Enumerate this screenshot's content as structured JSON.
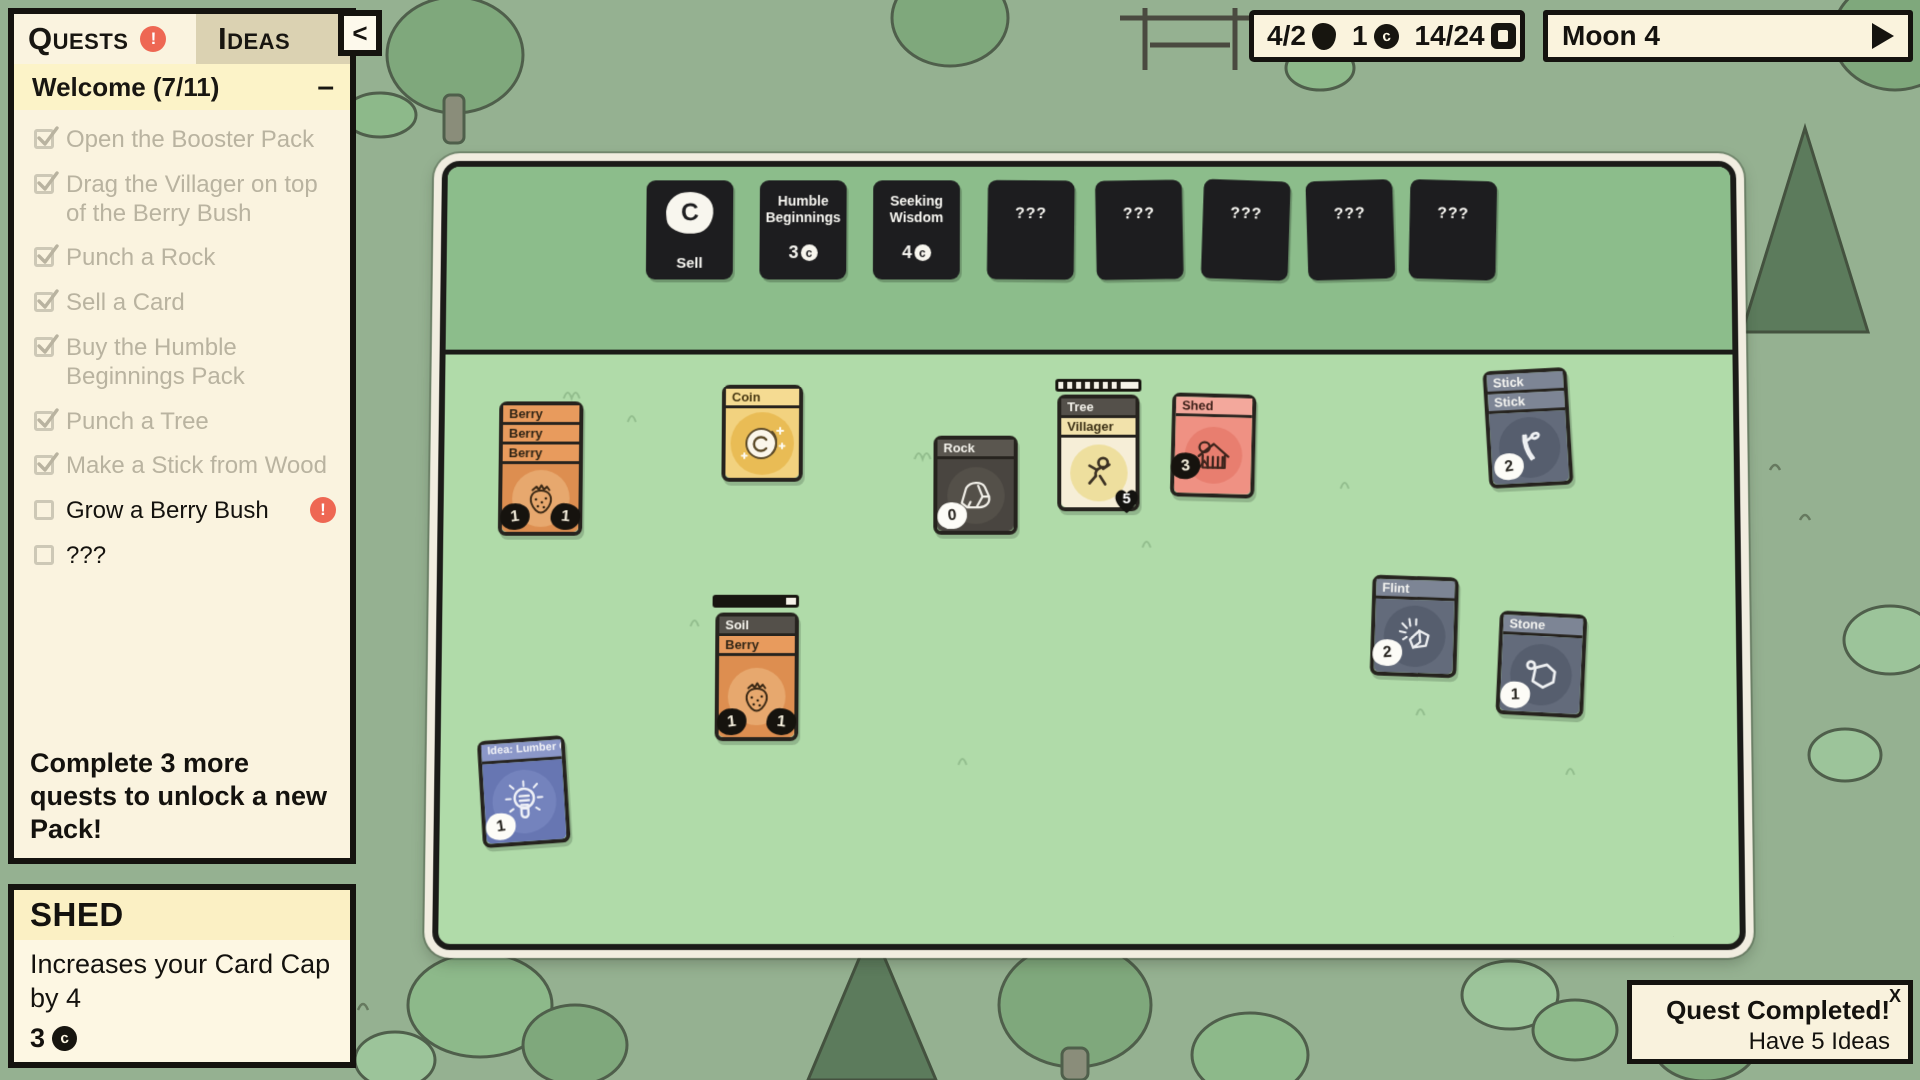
{
  "symbols": {
    "coin_upper": "C",
    "coin_lower": "c"
  },
  "quests": {
    "tab_quests": "Quests",
    "tab_ideas": "Ideas",
    "alert": "!",
    "collapse": "<",
    "group_title": "Welcome (7/11)",
    "minimize": "–",
    "items": [
      {
        "label": "Open the Booster Pack"
      },
      {
        "label": "Drag the Villager on top of the Berry Bush"
      },
      {
        "label": "Punch a Rock"
      },
      {
        "label": "Sell a Card"
      },
      {
        "label": "Buy the Humble Beginnings Pack"
      },
      {
        "label": "Punch a Tree"
      },
      {
        "label": "Make a Stick from Wood"
      },
      {
        "label": "Grow a Berry Bush",
        "alert": "!"
      },
      {
        "label": "???"
      }
    ],
    "footer": "Complete 3 more quests to unlock a new Pack!"
  },
  "info_panel": {
    "title": "SHED",
    "description": "Increases your Card Cap by 4",
    "sell_value": "3"
  },
  "resources": {
    "food": "4/2",
    "coins": "1",
    "card_cap": "14/24"
  },
  "timeline": {
    "label": "Moon 4"
  },
  "shop": {
    "sell_label": "Sell",
    "packs": [
      {
        "title": "Humble Beginnings",
        "cost": "3"
      },
      {
        "title": "Seeking Wisdom",
        "cost": "4"
      }
    ],
    "unknown": "???"
  },
  "cards": {
    "berry_stack": {
      "titles": [
        "Berry",
        "Berry",
        "Berry"
      ],
      "badge_left": "1",
      "badge_right": "1"
    },
    "coin": {
      "title": "Coin"
    },
    "rock": {
      "title": "Rock",
      "badge_left": "0"
    },
    "tree_villager": {
      "titles": [
        "Tree",
        "Villager"
      ],
      "heart": "5"
    },
    "shed": {
      "title": "Shed",
      "badge_left": "3"
    },
    "stick_stack": {
      "titles": [
        "Stick",
        "Stick"
      ],
      "badge_left": "2"
    },
    "soil_berry": {
      "titles": [
        "Soil",
        "Berry"
      ],
      "badge_left": "1",
      "badge_right": "1"
    },
    "flint": {
      "title": "Flint",
      "badge_left": "2"
    },
    "stone": {
      "title": "Stone",
      "badge_left": "1"
    },
    "idea": {
      "title": "Idea: Lumber Camp",
      "badge_left": "1"
    }
  },
  "toast": {
    "title": "Quest Completed!",
    "body": "Have 5 Ideas",
    "close": "X"
  }
}
